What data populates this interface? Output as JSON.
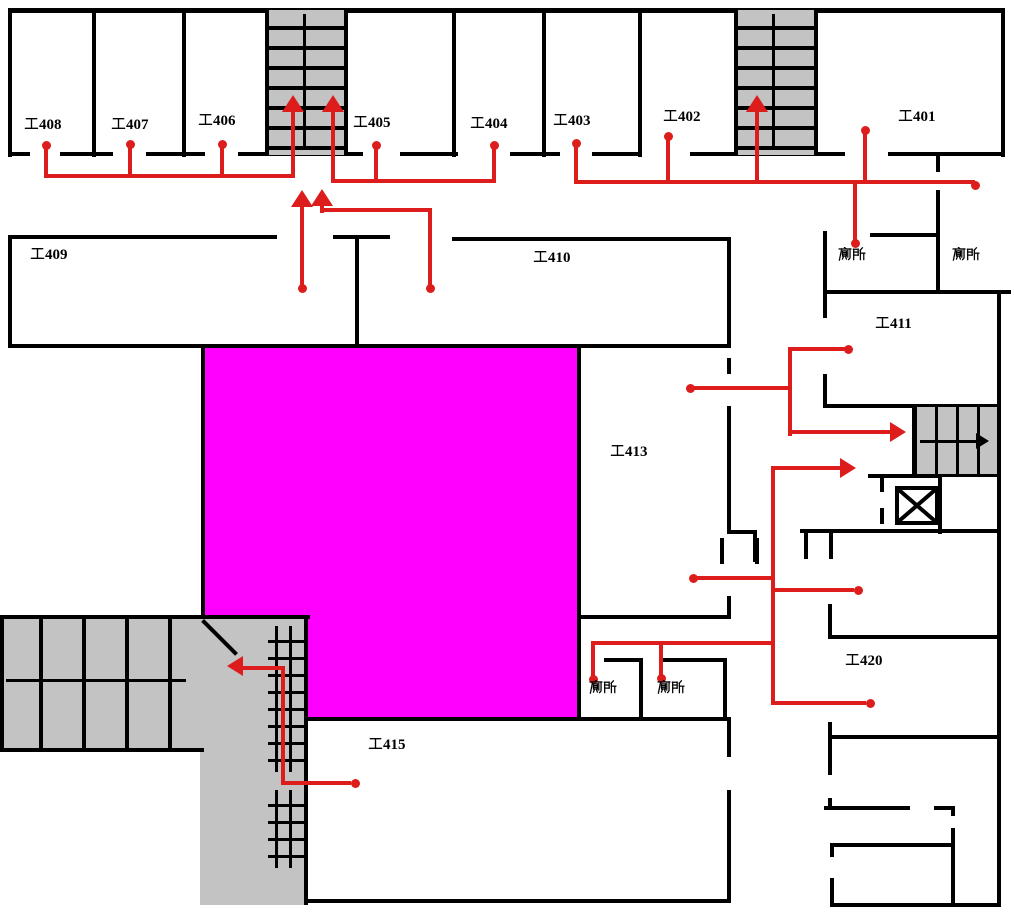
{
  "title": "4F evacuation floor plan",
  "colors": {
    "background": "#ffffff",
    "wall": "#000000",
    "route": "#dd1c1c",
    "atrium": "#ff00ff",
    "stair_fill": "#c3c3c3"
  },
  "rooms": {
    "r408": {
      "label": "工408"
    },
    "r407": {
      "label": "工407"
    },
    "r406": {
      "label": "工406"
    },
    "r405": {
      "label": "工405"
    },
    "r404": {
      "label": "工404"
    },
    "r403": {
      "label": "工403"
    },
    "r402": {
      "label": "工402"
    },
    "r401": {
      "label": "工401"
    },
    "r409": {
      "label": "工409"
    },
    "r410": {
      "label": "工410"
    },
    "r411": {
      "label": "工411"
    },
    "r413": {
      "label": "工413"
    },
    "r415": {
      "label": "工415"
    },
    "r420": {
      "label": "工420"
    }
  },
  "facilities": {
    "toilet_ne_left": {
      "label": "廁所"
    },
    "toilet_ne_right": {
      "label": "廁所"
    },
    "toilet_sw_left": {
      "label": "廁所"
    },
    "toilet_sw_right": {
      "label": "廁所"
    }
  },
  "icons": {
    "stairs": "stairs-icon (gray hatched block)",
    "elevator": "elevator-x-icon (square with X)",
    "route_dot": "route-origin-dot (red circle)",
    "route_arrow": "route-direction-arrow (red triangle)"
  }
}
